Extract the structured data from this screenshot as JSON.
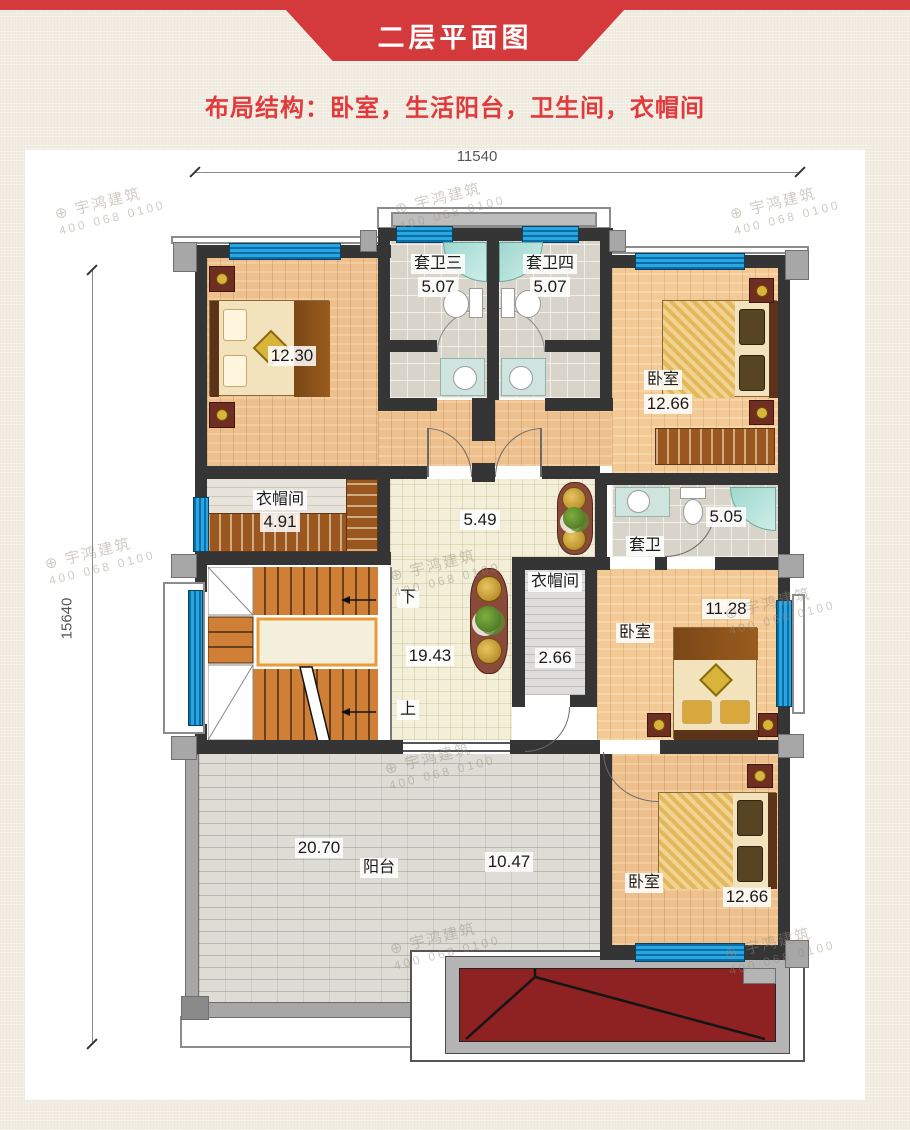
{
  "header": {
    "title": "二层平面图",
    "subtitle": "布局结构：卧室，生活阳台，卫生间，衣帽间"
  },
  "dimensions": {
    "width_top": "11540",
    "height_left": "15640"
  },
  "watermark": {
    "logo": "⊕",
    "brand": "宇鸿建筑",
    "phone": "400 068 0100"
  },
  "rooms": {
    "bedroom_top_left": {
      "area": "12.30"
    },
    "bath_three": {
      "label": "套卫三",
      "area": "5.07"
    },
    "bath_four": {
      "label": "套卫四",
      "area": "5.07"
    },
    "bedroom_top_right": {
      "label": "卧室",
      "area": "12.66"
    },
    "cloakroom_left": {
      "label": "衣帽间",
      "area": "4.91"
    },
    "hallway": {
      "area": "5.49"
    },
    "suite_bath": {
      "label": "套卫",
      "area": "5.05"
    },
    "cloakroom_middle": {
      "label": "衣帽间",
      "area": "2.66"
    },
    "bedroom_middle_right": {
      "label": "卧室",
      "area": "11.28"
    },
    "stairs": {
      "area": "19.43",
      "down": "下",
      "up": "上"
    },
    "balcony": {
      "label": "阳台",
      "area_left": "20.70",
      "area_right": "10.47"
    },
    "bedroom_bottom_right": {
      "label": "卧室",
      "area": "12.66"
    }
  },
  "colors": {
    "accent_red": "#d4393b",
    "wall_dark": "#353535",
    "window_blue": "#2196d3",
    "roof_red": "#8e2121",
    "wood_floor": "#eec08d",
    "tile_cream": "#f2eed8"
  }
}
